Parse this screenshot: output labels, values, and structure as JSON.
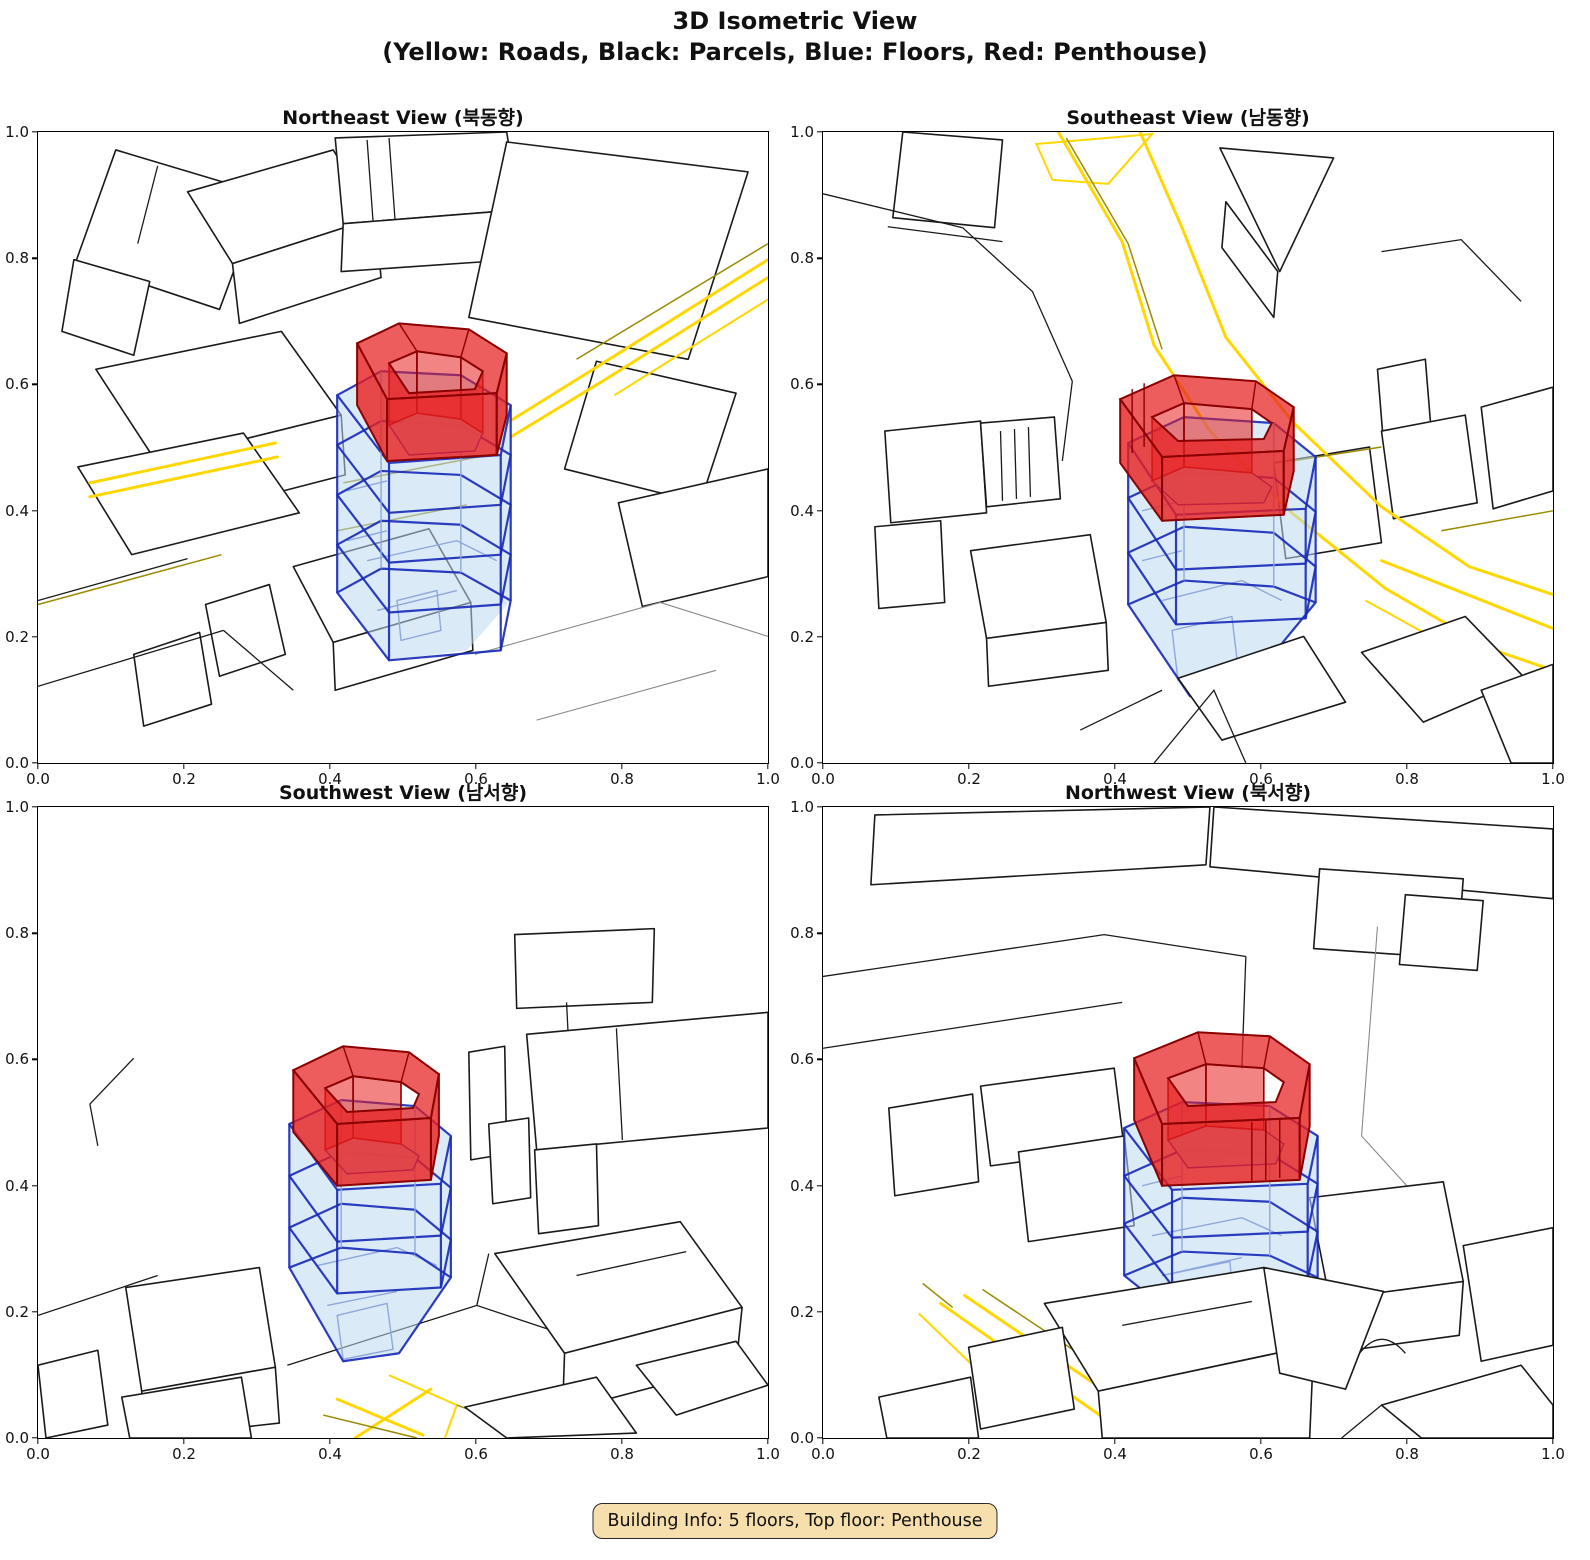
{
  "figure": {
    "title_line1": "3D Isometric View",
    "title_line2": "(Yellow: Roads, Black: Parcels, Blue: Floors, Red: Penthouse)",
    "footer_badge": "Building Info: 5 floors, Top floor: Penthouse"
  },
  "subplots": [
    {
      "id": "northeast",
      "title": "Northeast View (북동향)"
    },
    {
      "id": "southeast",
      "title": "Southeast View (남동향)"
    },
    {
      "id": "southwest",
      "title": "Southwest View (남서향)"
    },
    {
      "id": "northwest",
      "title": "Northwest View (북서향)"
    }
  ],
  "axes": {
    "x_ticks": [
      "0.0",
      "0.2",
      "0.4",
      "0.6",
      "0.8",
      "1.0"
    ],
    "y_ticks": [
      "0.0",
      "0.2",
      "0.4",
      "0.6",
      "0.8",
      "1.0"
    ],
    "x_range": [
      0.0,
      1.0
    ],
    "y_range": [
      0.0,
      1.0
    ]
  },
  "legend": {
    "roads": "Yellow",
    "parcels": "Black",
    "floors": "Blue",
    "penthouse": "Red"
  },
  "building": {
    "floors": 5,
    "top_floor": "Penthouse"
  },
  "colors": {
    "road": "#FFD700",
    "road_dark": "#9C8A00",
    "parcel": "#1a1a1a",
    "gray_line": "#888888",
    "floor_fill": "#BCD9EE",
    "floor_edge": "#1A2BB8",
    "floor_edge_light": "#8FA8DC",
    "penthouse_fill": "#E81F1F",
    "penthouse_edge": "#8B0000",
    "badge_bg": "#F6DFAD"
  },
  "chart_data": {
    "type": "3d_isometric_multiview",
    "figure_title": "3D Isometric View",
    "figure_subtitle": "(Yellow: Roads, Black: Parcels, Blue: Floors, Red: Penthouse)",
    "grid": "2x2",
    "views": [
      {
        "position": "top-left",
        "title": "Northeast View (북동향)",
        "xlim": [
          0,
          1
        ],
        "ylim": [
          0,
          1
        ],
        "x_ticks": [
          0,
          0.2,
          0.4,
          0.6,
          0.8,
          1.0
        ],
        "y_ticks": [
          0,
          0.2,
          0.4,
          0.6,
          0.8,
          1.0
        ]
      },
      {
        "position": "top-right",
        "title": "Southeast View (남동향)",
        "xlim": [
          0,
          1
        ],
        "ylim": [
          0,
          1
        ],
        "x_ticks": [
          0,
          0.2,
          0.4,
          0.6,
          0.8,
          1.0
        ],
        "y_ticks": [
          0,
          0.2,
          0.4,
          0.6,
          0.8,
          1.0
        ]
      },
      {
        "position": "bottom-left",
        "title": "Southwest View (남서향)",
        "xlim": [
          0,
          1
        ],
        "ylim": [
          0,
          1
        ],
        "x_ticks": [
          0,
          0.2,
          0.4,
          0.6,
          0.8,
          1.0
        ],
        "y_ticks": [
          0,
          0.2,
          0.4,
          0.6,
          0.8,
          1.0
        ]
      },
      {
        "position": "bottom-right",
        "title": "Northwest View (북서향)",
        "xlim": [
          0,
          1
        ],
        "ylim": [
          0,
          1
        ],
        "x_ticks": [
          0,
          0.2,
          0.4,
          0.6,
          0.8,
          1.0
        ],
        "y_ticks": [
          0,
          0.2,
          0.4,
          0.6,
          0.8,
          1.0
        ]
      }
    ],
    "layers": [
      {
        "name": "Roads",
        "color": "yellow"
      },
      {
        "name": "Parcels",
        "color": "black"
      },
      {
        "name": "Floors",
        "color": "blue"
      },
      {
        "name": "Penthouse",
        "color": "red"
      }
    ],
    "building_info": {
      "floors": 5,
      "top_floor": "Penthouse"
    }
  }
}
